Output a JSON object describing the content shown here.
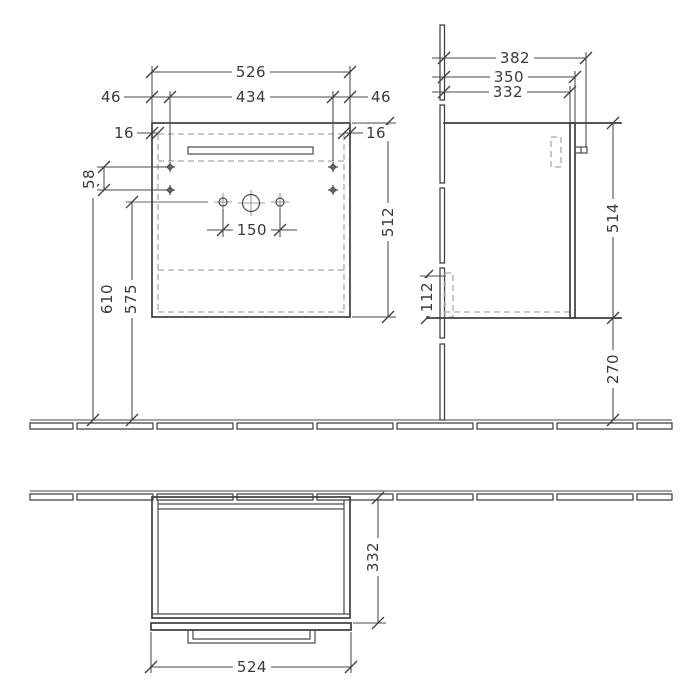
{
  "drawing": {
    "type": "furniture technical drawing, wall-hung vanity unit, three orthographic views",
    "colors": {
      "line": "#3e3e3e",
      "auxiliary": "#9b9b9b",
      "hidden_dashed": "#a9a9a9",
      "background": "#ffffff"
    },
    "front_view": {
      "overall_width": "526",
      "mounting_hole_spacing_h": "434",
      "offset_left": "46",
      "offset_right": "46",
      "panel_thickness_left": "16",
      "panel_thickness_right": "16",
      "mounting_hole_spacing_v": "58",
      "height_mounting_holes": "610",
      "height_trap_outlet": "575",
      "tap_hole_spacing": "150",
      "body_height": "512"
    },
    "side_view": {
      "depth_overall": "382",
      "depth_with_front": "350",
      "depth_body": "332",
      "body_height": "514",
      "rail_height": "112",
      "floor_clearance": "270"
    },
    "top_view": {
      "depth_body": "332",
      "front_width": "524"
    }
  }
}
